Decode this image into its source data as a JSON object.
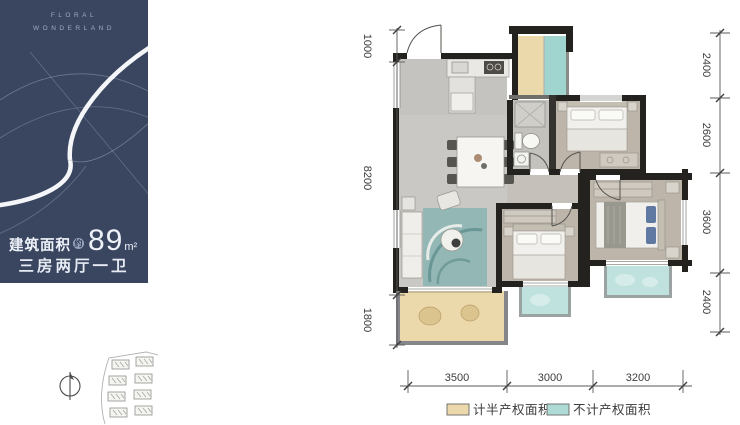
{
  "brand": {
    "line1": "FLORAL",
    "line2": "WONDERLAND"
  },
  "panel": {
    "area_label": "建筑面积",
    "approx": "约",
    "area_value": "89",
    "area_unit": "m²",
    "layout_text": "三房两厅一卫",
    "bg_color": "#3a4560"
  },
  "floor_plan": {
    "dims_left": [
      "1000",
      "8200",
      "1800"
    ],
    "dims_right": [
      "2400",
      "2600",
      "3600",
      "2400"
    ],
    "dims_bottom": [
      "3500",
      "3000",
      "3200"
    ],
    "legend": [
      {
        "label": "计半产权面积",
        "color": "#ecd9ab"
      },
      {
        "label": "不计产权面积",
        "color": "#aedbd6"
      }
    ],
    "colors": {
      "wall": "#23221f",
      "floor": "#c9c8c4",
      "bedroom_floor": "#bdb5aa",
      "accent_tan": "#ecd9ab",
      "accent_teal": "#aedbd6"
    }
  }
}
